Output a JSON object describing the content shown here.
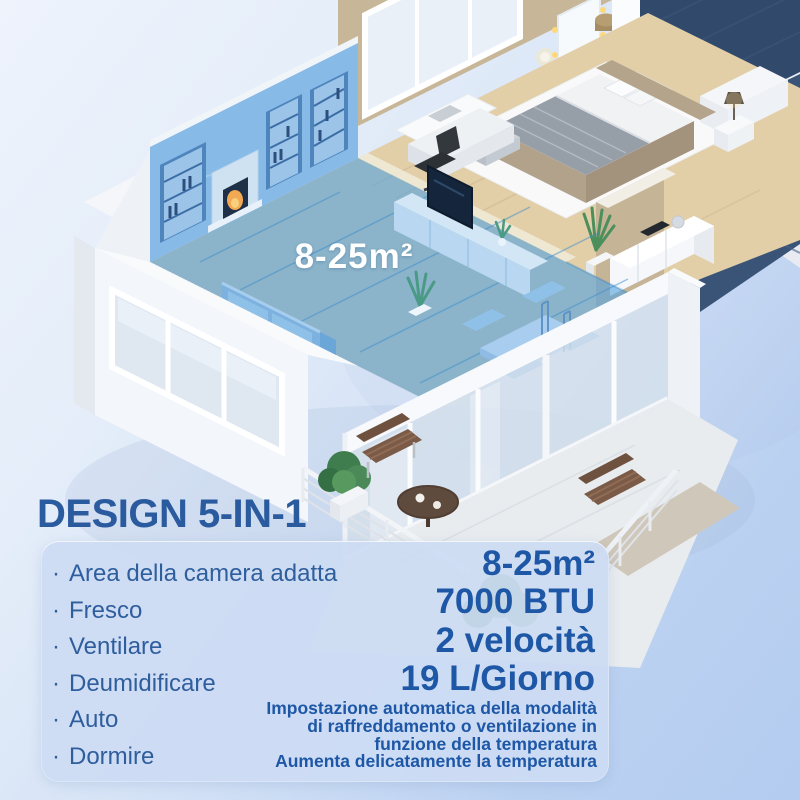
{
  "headline": "DESIGN 5-IN-1",
  "floorplan": {
    "area_label": "8-25m²"
  },
  "panel": {
    "bullet": "·",
    "features": [
      "Area della camera adatta",
      "Fresco",
      "Ventilare",
      "Deumidificare",
      "Auto",
      "Dormire"
    ],
    "specs": [
      "8-25m²",
      "7000 BTU",
      "2 velocità",
      "19 L/Giorno"
    ],
    "description_lines": [
      "Impostazione automatica della modalità",
      "di raffreddamento o ventilazione in",
      "funzione della temperatura",
      "Aumenta delicatamente la temperatura"
    ]
  },
  "colors": {
    "headline_text": "#2b5b9f",
    "accent_text": "#1d57a6",
    "panel_bg": "#ccdcf3",
    "coverage_highlight": "#55a3de",
    "floor_label_text": "#ffffff"
  }
}
